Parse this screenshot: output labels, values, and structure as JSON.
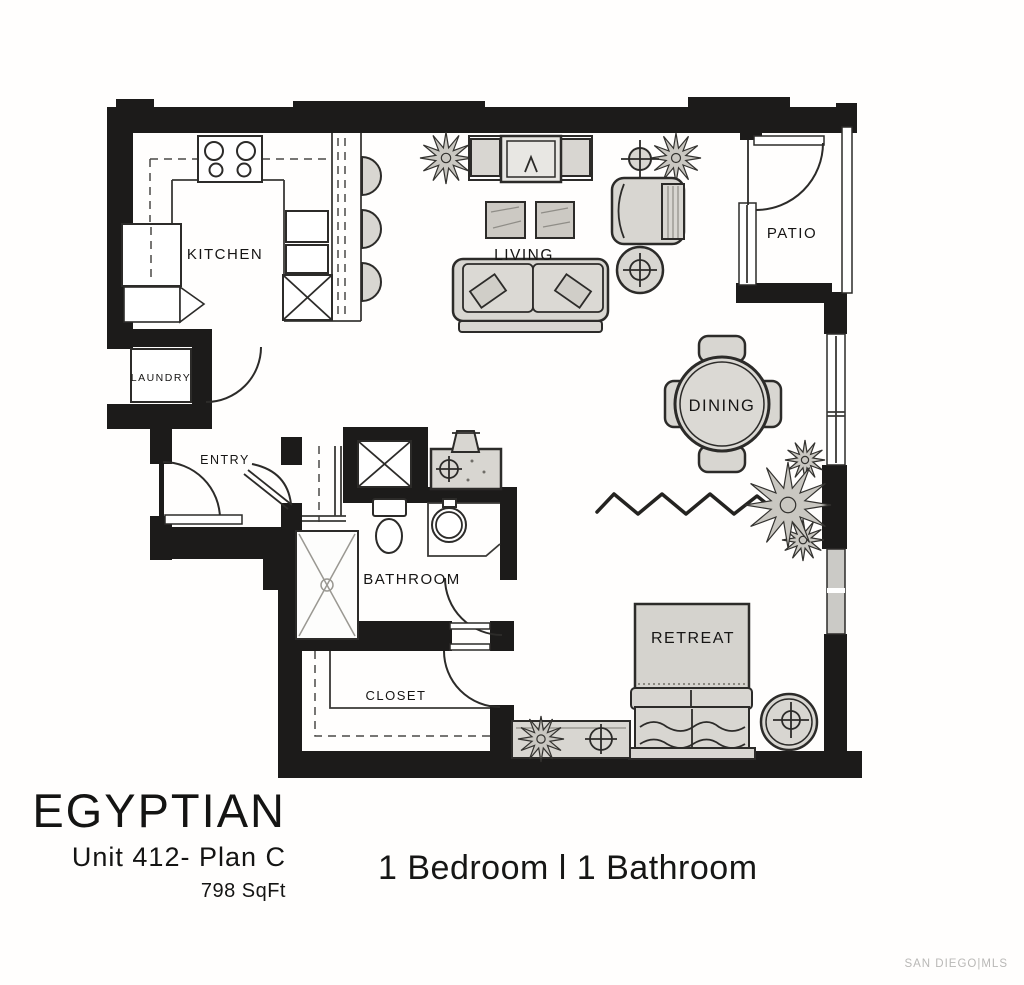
{
  "footer": {
    "name": "EGYPTIAN",
    "unit": "Unit 412- Plan C",
    "area": "798 SqFt",
    "config": "1 Bedroom l 1 Bathroom",
    "watermark": "SAN DIEGO|MLS"
  },
  "rooms": {
    "kitchen": "KITCHEN",
    "laundry": "LAUNDRY",
    "entry": "ENTRY",
    "living": "LIVING",
    "patio": "PATIO",
    "dining": "DINING",
    "bathroom": "BATHROOM",
    "closet": "CLOSET",
    "retreat": "RETREAT"
  },
  "colors": {
    "wall": "#1c1b1a",
    "furniture_fill": "#d8d6d1",
    "line": "#2c2b29",
    "watermark": "#b9b8b6",
    "background": "#fffefd"
  }
}
